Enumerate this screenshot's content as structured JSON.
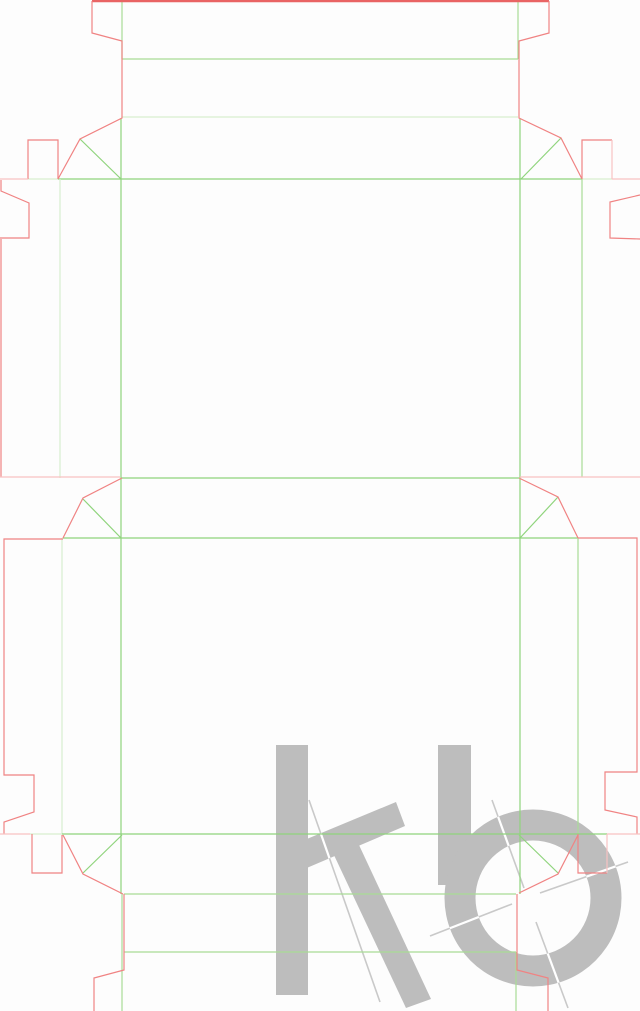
{
  "canvas": {
    "width": 640,
    "height": 1011,
    "background": "#fdfdfd"
  },
  "palette": {
    "cut": "#f08383",
    "cut_bold": "#e96464",
    "cut_pale": "#f8c2c2",
    "fold": "#8fd47c",
    "fold_med": "#a9dc96",
    "fold_pale": "#d8efcf",
    "watermark_gray": "#bdbdbd",
    "mark_line_gray": "#c9c9c9",
    "mark_line_over_shapes": "#ffffff"
  },
  "dieline": {
    "description": "two-part folding-carton die-cut template, cut lines red, crease lines green",
    "segments": [
      {
        "type": "cut_bold",
        "points": [
          [
            92,
            1
          ],
          [
            549,
            1
          ]
        ]
      },
      {
        "type": "cut",
        "points": [
          [
            92,
            1
          ],
          [
            92,
            33
          ],
          [
            122,
            41
          ],
          [
            122,
            118
          ],
          [
            80,
            139
          ],
          [
            58,
            179
          ]
        ]
      },
      {
        "type": "cut",
        "points": [
          [
            549,
            1
          ],
          [
            549,
            33
          ],
          [
            519,
            41
          ],
          [
            519,
            118
          ],
          [
            561,
            138
          ],
          [
            582,
            179
          ]
        ]
      },
      {
        "type": "cut",
        "points": [
          [
            28,
            179
          ],
          [
            28,
            140
          ],
          [
            58,
            140
          ],
          [
            58,
            179
          ]
        ]
      },
      {
        "type": "cut",
        "points": [
          [
            612,
            140
          ],
          [
            582,
            140
          ],
          [
            582,
            179
          ]
        ]
      },
      {
        "type": "cut_pale",
        "points": [
          [
            612,
            140
          ],
          [
            612,
            179
          ]
        ]
      },
      {
        "type": "cut_pale",
        "points": [
          [
            0,
            179
          ],
          [
            28,
            179
          ]
        ]
      },
      {
        "type": "cut_pale",
        "points": [
          [
            612,
            179
          ],
          [
            640,
            179
          ]
        ]
      },
      {
        "type": "cut",
        "points": [
          [
            1,
            180
          ],
          [
            1,
            191
          ],
          [
            29,
            203
          ],
          [
            29,
            238
          ],
          [
            0,
            238
          ]
        ]
      },
      {
        "type": "cut",
        "points": [
          [
            1,
            239
          ],
          [
            1,
            477
          ]
        ]
      },
      {
        "type": "cut",
        "points": [
          [
            640,
            195
          ],
          [
            610,
            202
          ],
          [
            610,
            238
          ],
          [
            640,
            239
          ]
        ]
      },
      {
        "type": "cut_pale",
        "points": [
          [
            0,
            477
          ],
          [
            120,
            477
          ]
        ]
      },
      {
        "type": "cut_pale",
        "points": [
          [
            520,
            477
          ],
          [
            640,
            477
          ]
        ]
      },
      {
        "type": "cut",
        "points": [
          [
            122,
            478
          ],
          [
            83,
            498
          ],
          [
            63,
            538
          ]
        ]
      },
      {
        "type": "cut",
        "points": [
          [
            519,
            478
          ],
          [
            558,
            497
          ],
          [
            578,
            538
          ]
        ]
      },
      {
        "type": "cut",
        "points": [
          [
            63,
            539
          ],
          [
            4,
            539
          ],
          [
            4,
            775
          ],
          [
            34,
            775
          ],
          [
            34,
            812
          ],
          [
            4,
            822
          ],
          [
            4,
            834
          ]
        ]
      },
      {
        "type": "cut",
        "points": [
          [
            578,
            538
          ],
          [
            637,
            538
          ],
          [
            637,
            772
          ],
          [
            605,
            772
          ],
          [
            605,
            810
          ],
          [
            637,
            817
          ],
          [
            637,
            834
          ]
        ]
      },
      {
        "type": "cut_pale",
        "points": [
          [
            0,
            834
          ],
          [
            30,
            834
          ]
        ]
      },
      {
        "type": "cut_pale",
        "points": [
          [
            607,
            834
          ],
          [
            640,
            834
          ]
        ]
      },
      {
        "type": "cut",
        "points": [
          [
            32,
            834
          ],
          [
            32,
            873
          ],
          [
            62,
            873
          ],
          [
            62,
            835
          ]
        ]
      },
      {
        "type": "cut",
        "points": [
          [
            578,
            834
          ],
          [
            578,
            873
          ],
          [
            607,
            873
          ]
        ]
      },
      {
        "type": "cut_pale",
        "points": [
          [
            607,
            873
          ],
          [
            607,
            834
          ]
        ]
      },
      {
        "type": "cut",
        "points": [
          [
            63,
            835
          ],
          [
            83,
            874
          ],
          [
            123,
            894
          ]
        ]
      },
      {
        "type": "cut",
        "points": [
          [
            578,
            835
          ],
          [
            558,
            874
          ],
          [
            519,
            893
          ]
        ]
      },
      {
        "type": "cut",
        "points": [
          [
            124,
            894
          ],
          [
            124,
            970
          ],
          [
            94,
            978
          ],
          [
            94,
            1011
          ]
        ]
      },
      {
        "type": "cut",
        "points": [
          [
            517,
            894
          ],
          [
            517,
            970
          ],
          [
            548,
            978
          ],
          [
            548,
            1011
          ]
        ]
      },
      {
        "type": "fold_med",
        "points": [
          [
            122,
            1
          ],
          [
            122,
            59
          ]
        ]
      },
      {
        "type": "fold_med",
        "points": [
          [
            518,
            1
          ],
          [
            518,
            59
          ]
        ]
      },
      {
        "type": "fold_med",
        "points": [
          [
            122,
            59
          ],
          [
            518,
            59
          ]
        ]
      },
      {
        "type": "fold_pale",
        "points": [
          [
            122,
            117
          ],
          [
            518,
            117
          ]
        ]
      },
      {
        "type": "fold_pale",
        "points": [
          [
            28,
            179
          ],
          [
            58,
            179
          ]
        ]
      },
      {
        "type": "fold",
        "points": [
          [
            58,
            179
          ],
          [
            582,
            179
          ]
        ]
      },
      {
        "type": "fold_pale",
        "points": [
          [
            582,
            179
          ],
          [
            612,
            179
          ]
        ]
      },
      {
        "type": "fold",
        "points": [
          [
            80,
            139
          ],
          [
            121,
            179
          ]
        ]
      },
      {
        "type": "fold",
        "points": [
          [
            561,
            138
          ],
          [
            521,
            179
          ]
        ]
      },
      {
        "type": "fold",
        "points": [
          [
            121,
            118
          ],
          [
            121,
            894
          ]
        ]
      },
      {
        "type": "fold",
        "points": [
          [
            520,
            118
          ],
          [
            520,
            894
          ]
        ]
      },
      {
        "type": "fold_pale",
        "points": [
          [
            60,
            179
          ],
          [
            60,
            478
          ]
        ]
      },
      {
        "type": "fold_med",
        "points": [
          [
            582,
            179
          ],
          [
            582,
            477
          ]
        ]
      },
      {
        "type": "fold",
        "points": [
          [
            121,
            478
          ],
          [
            519,
            478
          ]
        ]
      },
      {
        "type": "fold",
        "points": [
          [
            83,
            499
          ],
          [
            121,
            538
          ]
        ]
      },
      {
        "type": "fold",
        "points": [
          [
            558,
            497
          ],
          [
            520,
            538
          ]
        ]
      },
      {
        "type": "fold",
        "points": [
          [
            63,
            538
          ],
          [
            578,
            538
          ]
        ]
      },
      {
        "type": "fold_pale",
        "points": [
          [
            62,
            538
          ],
          [
            62,
            834
          ]
        ]
      },
      {
        "type": "fold_med",
        "points": [
          [
            578,
            538
          ],
          [
            578,
            834
          ]
        ]
      },
      {
        "type": "fold_pale",
        "points": [
          [
            30,
            834
          ],
          [
            62,
            834
          ]
        ]
      },
      {
        "type": "fold",
        "points": [
          [
            62,
            834
          ],
          [
            607,
            834
          ]
        ]
      },
      {
        "type": "fold",
        "points": [
          [
            83,
            873
          ],
          [
            122,
            835
          ]
        ]
      },
      {
        "type": "fold",
        "points": [
          [
            558,
            873
          ],
          [
            519,
            835
          ]
        ]
      },
      {
        "type": "fold_med",
        "points": [
          [
            124,
            894
          ],
          [
            516,
            894
          ]
        ]
      },
      {
        "type": "fold_med",
        "points": [
          [
            124,
            952
          ],
          [
            516,
            952
          ]
        ]
      },
      {
        "type": "fold_med",
        "points": [
          [
            122,
            894
          ],
          [
            122,
            1011
          ]
        ]
      },
      {
        "type": "fold_med",
        "points": [
          [
            516,
            952
          ],
          [
            516,
            1011
          ]
        ]
      }
    ]
  },
  "watermark": {
    "text": "kb",
    "color": "#bdbdbd",
    "k_stem": [
      276,
      745,
      32,
      250
    ],
    "k_arm": [
      [
        302,
        841
      ],
      [
        396,
        802
      ],
      [
        405,
        826
      ],
      [
        302,
        870
      ]
    ],
    "k_leg": [
      [
        333,
        853
      ],
      [
        359,
        845
      ],
      [
        431,
        999
      ],
      [
        406,
        1008
      ]
    ],
    "b_stem": [
      438,
      745,
      33,
      140
    ],
    "b_ring": {
      "cx": 533,
      "cy": 898,
      "r": 73,
      "stroke_width": 31
    },
    "construction_lines": [
      [
        309,
        800,
        380,
        1002
      ],
      [
        492,
        800,
        524,
        888
      ],
      [
        536,
        922,
        568,
        1008
      ],
      [
        430,
        936,
        512,
        904
      ],
      [
        540,
        893,
        628,
        862
      ]
    ]
  }
}
